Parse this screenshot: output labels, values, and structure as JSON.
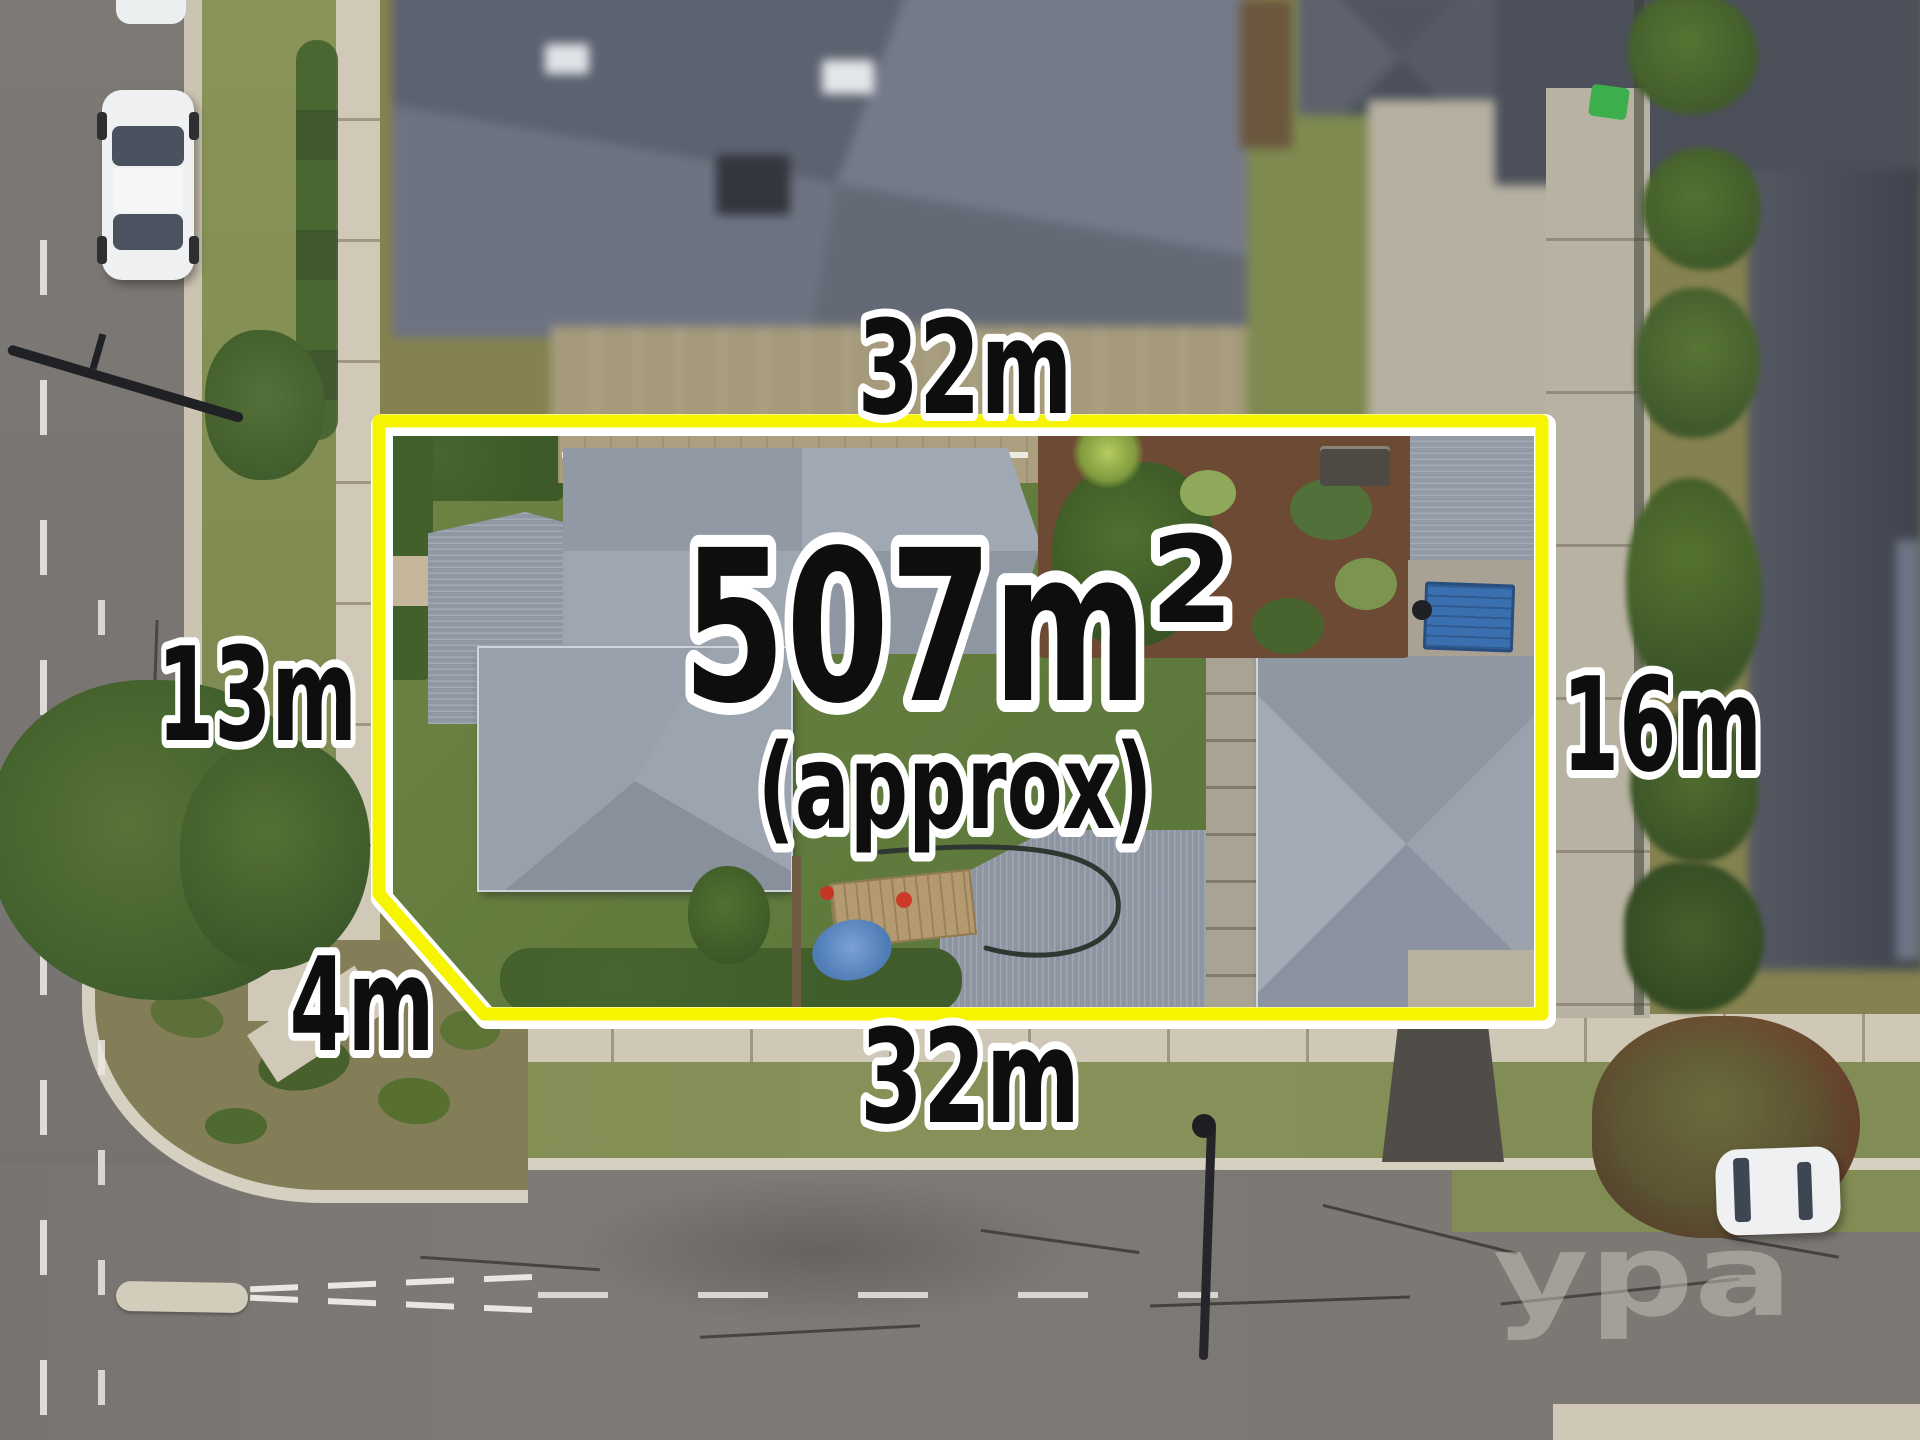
{
  "annotations": {
    "area_value": "507m",
    "area_superscript": "2",
    "area_qualifier": "(approx)",
    "dim_top": "32m",
    "dim_bottom": "32m",
    "dim_left": "13m",
    "dim_right": "16m",
    "dim_splay": "4m"
  },
  "watermark": "ypa",
  "colors": {
    "boundary": "#f7f400",
    "boundary_casing": "#ffffff",
    "label_fill": "#0e0e0e",
    "label_outline": "#ffffff",
    "watermark_fill": "#ccc7bd"
  }
}
